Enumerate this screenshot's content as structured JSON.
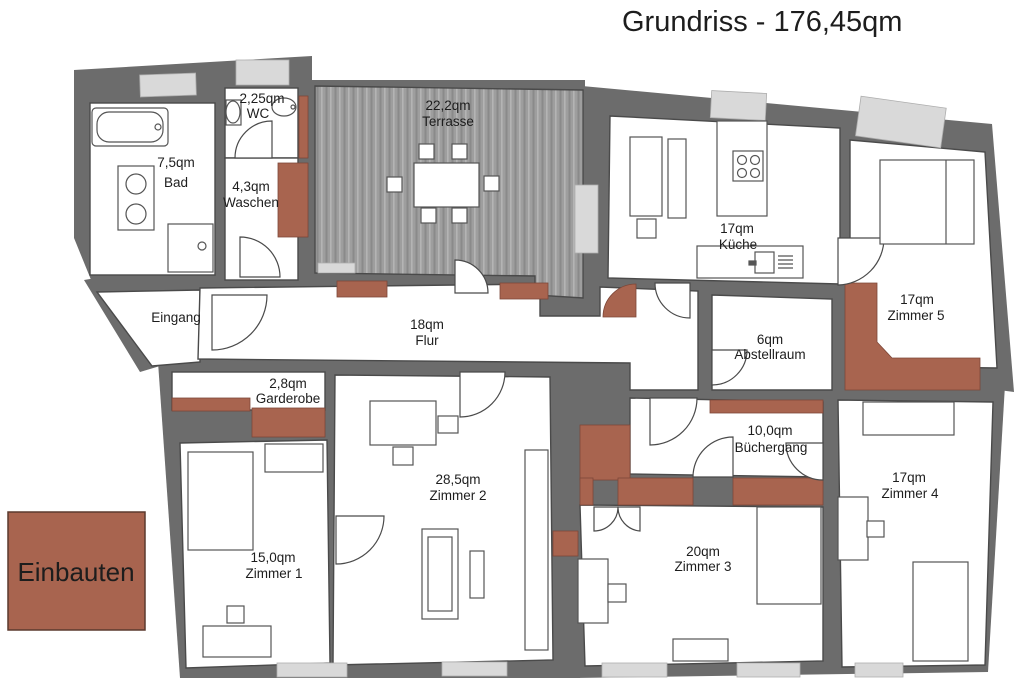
{
  "title": "Grundriss - 176,45qm",
  "legend": {
    "label": "Einbauten"
  },
  "colors": {
    "wall": "#6c6c6c",
    "window": "#d9d9d9",
    "einbauten": "#a8644f",
    "room_fill": "#ffffff",
    "terrace_base": "#9e9e9e",
    "outline": "#4a4a4a",
    "text": "#1d1d1d"
  },
  "rooms": {
    "bad": {
      "area": "7,5qm",
      "name": "Bad"
    },
    "wc": {
      "area": "2,25qm",
      "name": "WC"
    },
    "waschen": {
      "area": "4,3qm",
      "name": "Waschen"
    },
    "terrasse": {
      "area": "22,2qm",
      "name": "Terrasse"
    },
    "kueche": {
      "area": "17qm",
      "name": "Küche"
    },
    "zimmer5": {
      "area": "17qm",
      "name": "Zimmer 5"
    },
    "eingang": {
      "name": "Eingang"
    },
    "flur": {
      "area": "18qm",
      "name": "Flur"
    },
    "abstellraum": {
      "area": "6qm",
      "name": "Abstellraum"
    },
    "garderobe": {
      "area": "2,8qm",
      "name": "Garderobe"
    },
    "zimmer1": {
      "area": "15,0qm",
      "name": "Zimmer 1"
    },
    "zimmer2": {
      "area": "28,5qm",
      "name": "Zimmer 2"
    },
    "zimmer3": {
      "area": "20qm",
      "name": "Zimmer 3"
    },
    "zimmer4": {
      "area": "17qm",
      "name": "Zimmer 4"
    },
    "buechergang": {
      "area": "10,0qm",
      "name": "Büchergang"
    }
  }
}
